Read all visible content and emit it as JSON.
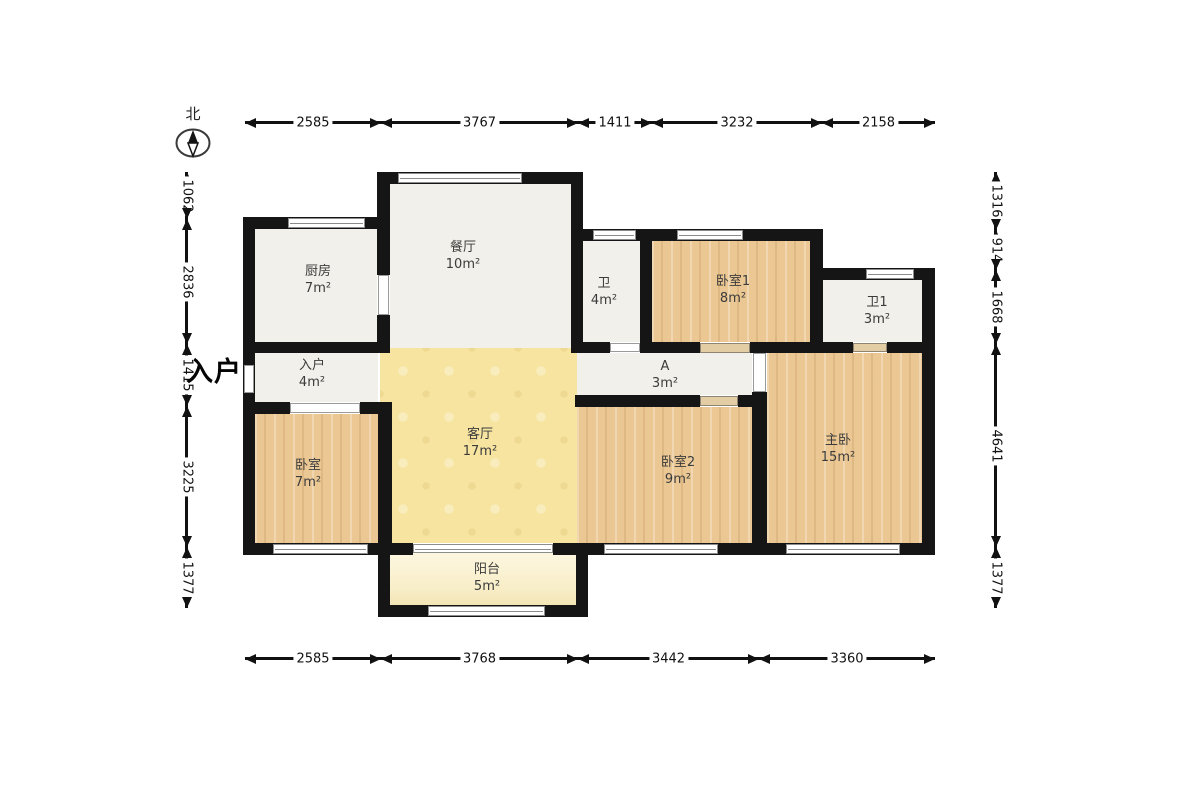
{
  "north": {
    "label": "北"
  },
  "entrance": {
    "label": "入户"
  },
  "rooms": {
    "kitchen": {
      "name": "厨房",
      "area": "7m²"
    },
    "dining": {
      "name": "餐厅",
      "area": "10m²"
    },
    "entry": {
      "name": "入户",
      "area": "4m²"
    },
    "bedroom_w": {
      "name": "卧室",
      "area": "7m²"
    },
    "living": {
      "name": "客厅",
      "area": "17m²"
    },
    "balcony": {
      "name": "阳台",
      "area": "5m²"
    },
    "bath": {
      "name": "卫",
      "area": "4m²"
    },
    "bedroom1": {
      "name": "卧室1",
      "area": "8m²"
    },
    "bath1": {
      "name": "卫1",
      "area": "3m²"
    },
    "hall_a": {
      "name": "A",
      "area": "3m²"
    },
    "bedroom2": {
      "name": "卧室2",
      "area": "9m²"
    },
    "master": {
      "name": "主卧",
      "area": "15m²"
    }
  },
  "dimensions": {
    "top": [
      "2585",
      "3767",
      "1411",
      "3232",
      "2158"
    ],
    "bottom": [
      "2585",
      "3768",
      "3442",
      "3360"
    ],
    "left": [
      "1062",
      "2836",
      "1415",
      "3225",
      "1377"
    ],
    "right": [
      "1316",
      "914",
      "1668",
      "4641",
      "1377"
    ]
  },
  "colors": {
    "wall": "#151515",
    "wood": "#ebc793",
    "tile_gray": "#f2f0ea",
    "living_yellow": "#f6e4a0",
    "balcony_cream": "#faf2d2",
    "line": "#111111"
  }
}
